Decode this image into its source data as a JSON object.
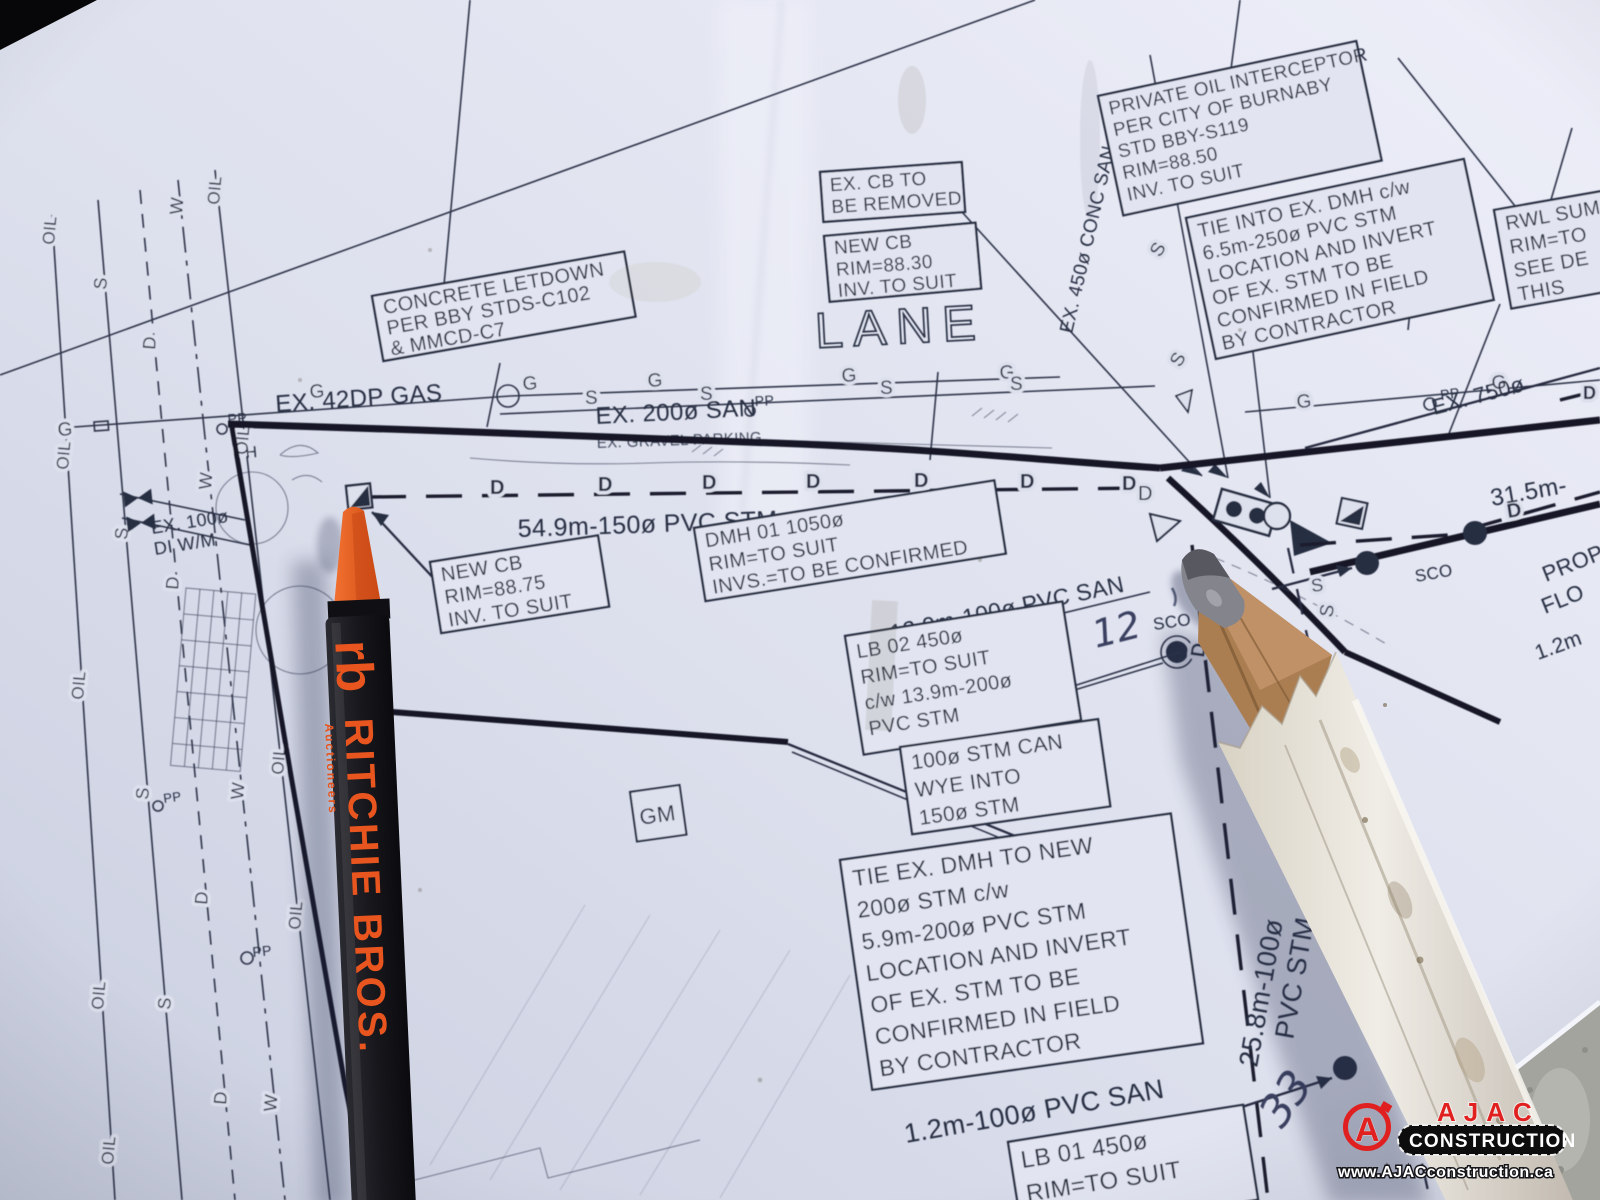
{
  "drawing": {
    "boxes": {
      "concrete_letdown": [
        "CONCRETE LETDOWN",
        "PER BBY STDS-C102",
        "& MMCD-C7"
      ],
      "ex_cb_removed": [
        "EX. CB TO",
        "BE REMOVED"
      ],
      "new_cb_8830": [
        "NEW CB",
        "RIM=88.30",
        "INV. TO SUIT"
      ],
      "oil_interceptor": [
        "PRIVATE OIL INTERCEPTOR",
        "PER CITY OF BURNABY",
        "STD BBY-S119",
        "RIM=88.50",
        "INV. TO SUIT"
      ],
      "tie_into_dmh": [
        "TIE INTO EX. DMH c/w",
        "6.5m-250ø PVC STM",
        "LOCATION AND INVERT",
        "OF EX. STM TO BE",
        "CONFIRMED IN FIELD",
        "BY CONTRACTOR"
      ],
      "rwl_sump": [
        "RWL SUM",
        "RIM=TO",
        "SEE DE",
        "THIS"
      ],
      "new_cb_8875": [
        "NEW CB",
        "RIM=88.75",
        "INV. TO SUIT"
      ],
      "dmh_01": [
        "DMH 01 1050ø",
        "RIM=TO SUIT",
        "INVS.=TO BE CONFIRMED"
      ],
      "lb_02": [
        "LB 02 450ø",
        "RIM=TO SUIT",
        "c/w 13.9m-200ø",
        "PVC STM"
      ],
      "stm_wye": [
        "100ø STM CAN",
        "WYE INTO",
        "150ø STM"
      ],
      "tie_ex_dmh": [
        "TIE EX. DMH TO NEW",
        "200ø STM c/w",
        "5.9m-200ø PVC STM",
        "LOCATION AND INVERT",
        "OF EX. STM TO BE",
        "CONFIRMED IN FIELD",
        "BY CONTRACTOR"
      ],
      "lb_01": [
        "LB 01 450ø",
        "RIM=TO SUIT"
      ]
    },
    "labels": {
      "lane": "LANE",
      "ex_gas": "EX. 42DP GAS",
      "ex_san": "EX. 200ø SAN",
      "gravel": "EX. GRAVEL PARKING",
      "stm_549": "54.9m-150ø PVC STM",
      "san_129": "12.9m-100ø PVC SAN",
      "san_12": "1.2m-100ø PVC SAN",
      "stm_258_a": "25.8m-100ø",
      "stm_258_b": "PVC STM",
      "conc_san": "EX. 450ø CONC SAN",
      "wm_a": "EX. 100ø",
      "wm_b": "DI  W/M",
      "ex_750": "EX. 750ø",
      "dist_315": "31.5m-",
      "prop_a": "PROP",
      "prop_b": "FLO",
      "dim_12": "1.2m",
      "gm": "GM",
      "pp": "PP",
      "h": "H",
      "sco": "SCO"
    },
    "line_letters": {
      "gas": "G",
      "san": "S",
      "storm": "D",
      "water": "W",
      "oil": "OIL"
    },
    "handwriting": {
      "mark_12": "12",
      "mark_33": "33"
    },
    "ink_color": "#2c3246"
  },
  "objects": {
    "marker": {
      "logo_initials": "rb",
      "brand": "RITCHIE BROS.",
      "sub_brand": "Auctioneers",
      "accent": "#e8551e"
    }
  },
  "watermark": {
    "monogram": "A",
    "name": "AJAC",
    "banner": "CONSTRUCTION",
    "url": "www.AJACconstruction.ca",
    "red": "#e02020"
  }
}
